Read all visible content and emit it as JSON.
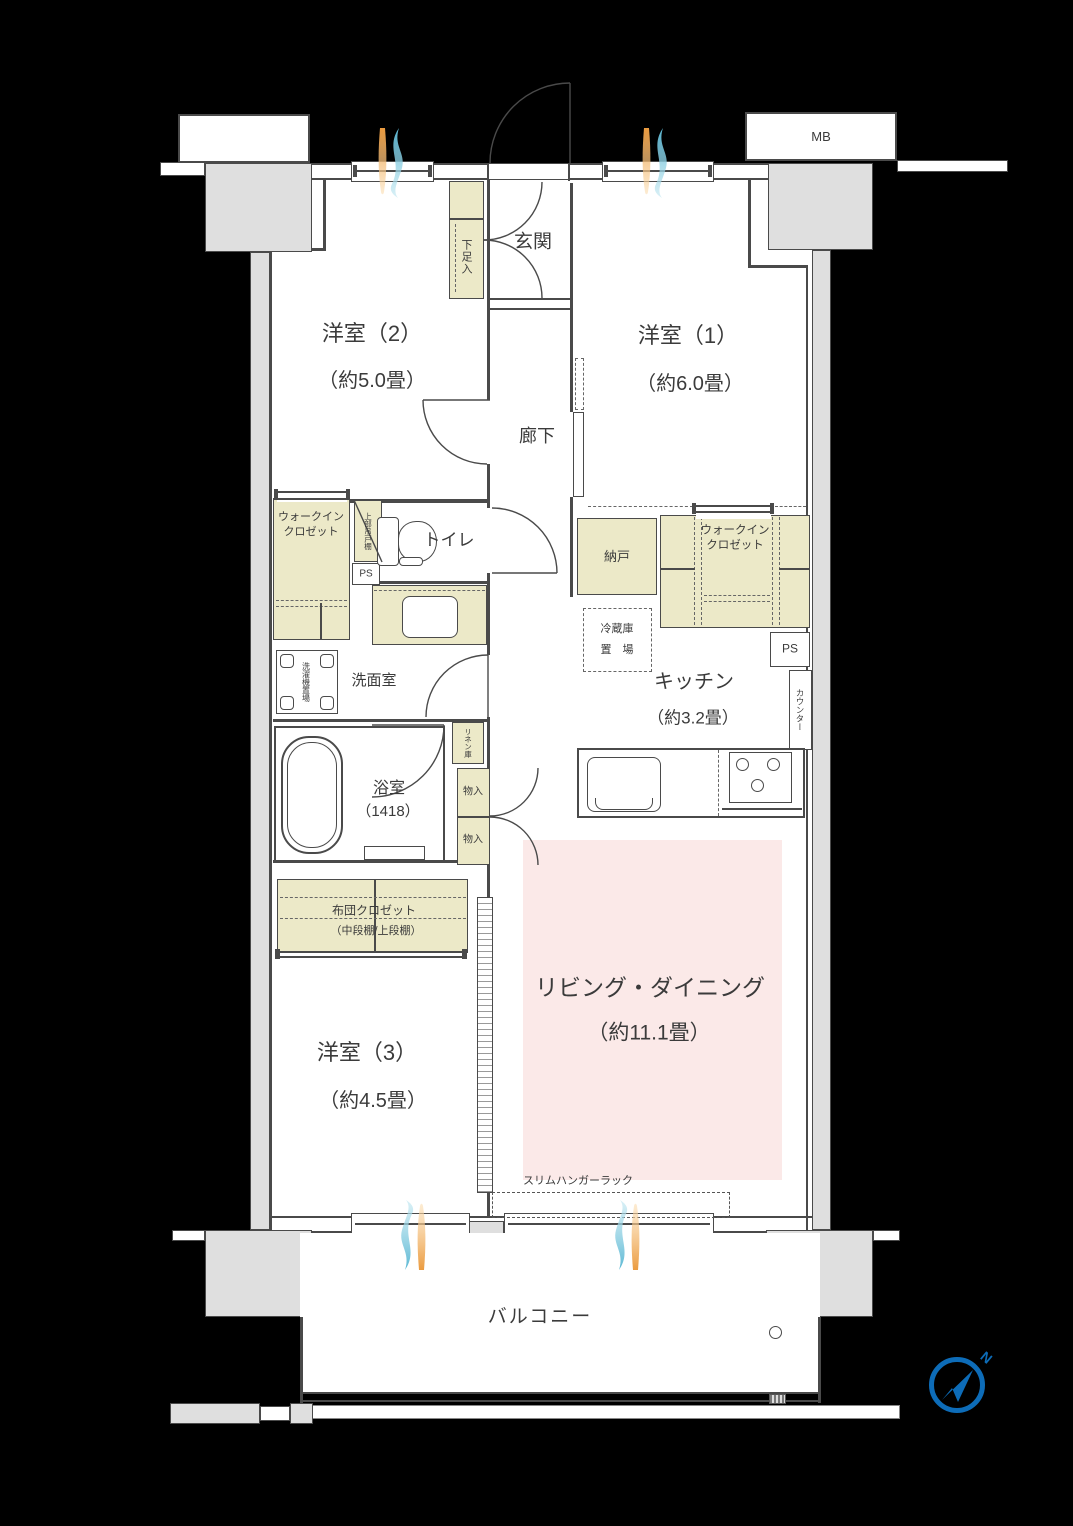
{
  "rooms": {
    "y2": {
      "name": "洋室（2）",
      "size": "（約5.0畳）"
    },
    "y1": {
      "name": "洋室（1）",
      "size": "（約6.0畳）"
    },
    "y3": {
      "name": "洋室（3）",
      "size": "（約4.5畳）"
    },
    "ld": {
      "name": "リビング・ダイニング",
      "size": "（約11.1畳）"
    },
    "kitchen": {
      "name": "キッチン",
      "size": "（約3.2畳）"
    },
    "genkan": "玄関",
    "rouka": "廊下",
    "toilet": "トイレ",
    "senmen": "洗面室",
    "bath": {
      "name": "浴室",
      "size": "（1418）"
    },
    "nando": "納戸",
    "balcony": "バルコニー"
  },
  "storage": {
    "geta": "下足入",
    "wic1": "ウォークイン",
    "wic2": "クロゼット",
    "joubu": "上部吊戸棚",
    "linen": "リネン庫",
    "mono": "物入",
    "futon1": "布団クロゼット",
    "futon2": "（中段棚/上段棚）",
    "fridge1": "冷蔵庫",
    "fridge2": "置　場",
    "washer": "洗濯機置場",
    "counter": "カウンター",
    "hanger": "スリムハンガーラック"
  },
  "labels": {
    "mb": "MB",
    "ps": "PS",
    "north": "N"
  },
  "colors": {
    "background": "#000000",
    "wall_line": "#4a4a4a",
    "pillar_gray": "#dfdfdf",
    "closet_cream": "#ece9c8",
    "living_pink": "#fbe9e8",
    "compass_blue": "#0d6cb8",
    "vent_orange": "#f2a75e",
    "vent_blue": "#8fd0e2"
  }
}
